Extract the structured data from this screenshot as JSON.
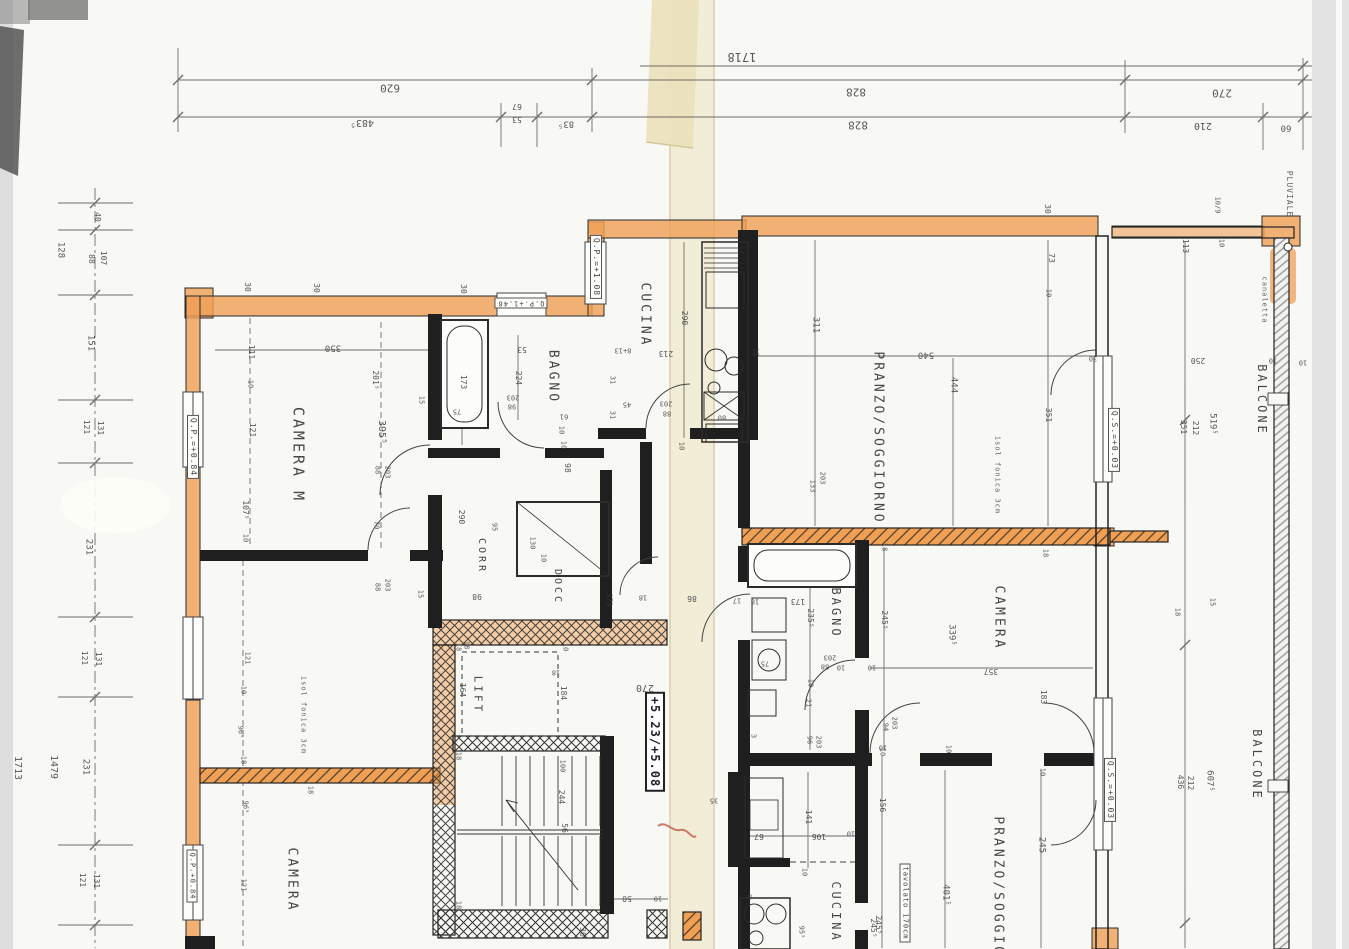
{
  "sheet": {
    "drawing_type": "scanned architectural floor plan, drawing rotated 180°",
    "overall_dimension": "1718",
    "rooms": [
      "CAMERA M",
      "CAMERA",
      "CAMERA",
      "BAGNO",
      "BAGNO",
      "CUCINA",
      "CUCINA",
      "CORR",
      "DOCC",
      "LIFT",
      "PRANZO/SOGGIORNO",
      "PRANZO/SOGGIORNO",
      "BALCONE",
      "BALCONE"
    ],
    "level_marks": [
      "Q.P.=+1.08",
      "Q.P.=+0.84",
      "Q.P.+1.48",
      "Q.S.=+0.03",
      "+5.23/+5.08"
    ],
    "notes": [
      "PLUVIALE",
      "canaletta",
      "isol fonica 3cm",
      "tavolato 170cm"
    ]
  },
  "colors": {
    "highlight_orange": "#efa058",
    "paper": "#f8f8f5",
    "fold_cream": "#f1ebd4",
    "line": "#222222",
    "scan_gray": "#dedede",
    "red_mark": "#b93a2e"
  },
  "annotations": [
    {
      "t": "1718",
      "x": 742,
      "y": 57,
      "r": 180,
      "s": 12
    },
    {
      "t": "620",
      "x": 390,
      "y": 88,
      "r": 180,
      "s": 11
    },
    {
      "t": "828",
      "x": 856,
      "y": 92,
      "r": 180,
      "s": 11
    },
    {
      "t": "483⁵",
      "x": 362,
      "y": 122,
      "r": 180,
      "s": 10
    },
    {
      "t": "67",
      "x": 517,
      "y": 106,
      "r": 180,
      "s": 8
    },
    {
      "t": "53",
      "x": 517,
      "y": 119,
      "r": 180,
      "s": 8
    },
    {
      "t": "83⁵",
      "x": 566,
      "y": 123,
      "r": 180,
      "s": 9
    },
    {
      "t": "828",
      "x": 858,
      "y": 125,
      "r": 180,
      "s": 11
    },
    {
      "t": "270",
      "x": 1222,
      "y": 93,
      "r": 180,
      "s": 11
    },
    {
      "t": "210",
      "x": 1203,
      "y": 125,
      "r": 180,
      "s": 10
    },
    {
      "t": "60",
      "x": 1286,
      "y": 127,
      "r": 180,
      "s": 9
    },
    {
      "t": "40",
      "x": 97,
      "y": 217,
      "s": 8
    },
    {
      "t": "128",
      "x": 60,
      "y": 250
    },
    {
      "t": "88",
      "x": 91,
      "y": 259,
      "s": 8
    },
    {
      "t": "107",
      "x": 103,
      "y": 258,
      "s": 8
    },
    {
      "t": "151",
      "x": 90,
      "y": 343
    },
    {
      "t": "121",
      "x": 86,
      "y": 427,
      "s": 8
    },
    {
      "t": "131",
      "x": 100,
      "y": 428,
      "s": 8
    },
    {
      "t": "231",
      "x": 88,
      "y": 547
    },
    {
      "t": "121",
      "x": 84,
      "y": 658,
      "s": 8
    },
    {
      "t": "131",
      "x": 98,
      "y": 659,
      "s": 8
    },
    {
      "t": "231",
      "x": 85,
      "y": 767
    },
    {
      "t": "1713",
      "x": 17,
      "y": 768,
      "s": 10
    },
    {
      "t": "1479",
      "x": 53,
      "y": 767,
      "s": 10
    },
    {
      "t": "121",
      "x": 82,
      "y": 880,
      "s": 8
    },
    {
      "t": "131",
      "x": 96,
      "y": 881,
      "s": 8
    },
    {
      "t": "30",
      "x": 247,
      "y": 287,
      "s": 8
    },
    {
      "t": "30",
      "x": 316,
      "y": 288,
      "s": 8
    },
    {
      "t": "111",
      "x": 251,
      "y": 352,
      "s": 8
    },
    {
      "t": "350",
      "x": 333,
      "y": 347,
      "r": 180,
      "s": 9
    },
    {
      "t": "10",
      "x": 250,
      "y": 384,
      "s": 7
    },
    {
      "t": "121",
      "x": 252,
      "y": 430,
      "s": 8
    },
    {
      "t": "395⁵",
      "x": 381,
      "y": 432,
      "s": 10
    },
    {
      "t": "CAMERA M",
      "x": 298,
      "y": 455,
      "s": 15,
      "k": "room"
    },
    {
      "t": "Q.P.=+0.84",
      "x": 193,
      "y": 447,
      "s": 8,
      "k": "level"
    },
    {
      "t": "201⁵",
      "x": 375,
      "y": 380,
      "s": 8
    },
    {
      "t": "15",
      "x": 421,
      "y": 400,
      "s": 7
    },
    {
      "t": "88",
      "x": 377,
      "y": 470,
      "s": 7
    },
    {
      "t": "203",
      "x": 387,
      "y": 472,
      "s": 7
    },
    {
      "t": "107⁵",
      "x": 245,
      "y": 510,
      "s": 8
    },
    {
      "t": "10",
      "x": 245,
      "y": 538,
      "s": 7
    },
    {
      "t": "70",
      "x": 376,
      "y": 525,
      "s": 7
    },
    {
      "t": "30",
      "x": 463,
      "y": 289,
      "s": 8
    },
    {
      "t": "Q.P.+1.48",
      "x": 521,
      "y": 303,
      "r": 180,
      "s": 7,
      "k": "level"
    },
    {
      "t": "173",
      "x": 463,
      "y": 382,
      "s": 8
    },
    {
      "t": "75",
      "x": 457,
      "y": 411,
      "r": 180,
      "s": 7
    },
    {
      "t": "53",
      "x": 522,
      "y": 349,
      "r": 180,
      "s": 8
    },
    {
      "t": "224",
      "x": 518,
      "y": 378,
      "s": 8
    },
    {
      "t": "BAGNO",
      "x": 553,
      "y": 377,
      "s": 13,
      "k": "room"
    },
    {
      "t": "203",
      "x": 513,
      "y": 397,
      "r": 180,
      "s": 7
    },
    {
      "t": "98",
      "x": 512,
      "y": 406,
      "r": 180,
      "s": 7
    },
    {
      "t": "61",
      "x": 564,
      "y": 416,
      "r": 180,
      "s": 7
    },
    {
      "t": "10",
      "x": 561,
      "y": 430,
      "s": 7
    },
    {
      "t": "10",
      "x": 563,
      "y": 445,
      "s": 7
    },
    {
      "t": "98",
      "x": 567,
      "y": 468,
      "s": 8
    },
    {
      "t": "8+13",
      "x": 623,
      "y": 350,
      "r": 180,
      "s": 7
    },
    {
      "t": "31",
      "x": 612,
      "y": 380,
      "s": 7
    },
    {
      "t": "45",
      "x": 627,
      "y": 404,
      "r": 180,
      "s": 7
    },
    {
      "t": "31",
      "x": 612,
      "y": 415,
      "s": 7
    },
    {
      "t": "Q.P.=+1.08",
      "x": 596,
      "y": 267,
      "s": 8,
      "k": "level"
    },
    {
      "t": "CUCINA",
      "x": 645,
      "y": 315,
      "s": 13,
      "k": "room"
    },
    {
      "t": "290",
      "x": 684,
      "y": 318,
      "s": 8
    },
    {
      "t": "213",
      "x": 666,
      "y": 353,
      "r": 180,
      "s": 8
    },
    {
      "t": "15",
      "x": 755,
      "y": 352,
      "s": 7
    },
    {
      "t": "311",
      "x": 815,
      "y": 325,
      "s": 9
    },
    {
      "t": "203",
      "x": 666,
      "y": 403,
      "r": 180,
      "s": 7
    },
    {
      "t": "88",
      "x": 667,
      "y": 413,
      "r": 180,
      "s": 7
    },
    {
      "t": "80",
      "x": 722,
      "y": 417,
      "r": 180,
      "s": 7
    },
    {
      "t": "10",
      "x": 681,
      "y": 446,
      "s": 7
    },
    {
      "t": "CORR",
      "x": 481,
      "y": 556,
      "s": 10,
      "k": "room"
    },
    {
      "t": "DOCC",
      "x": 557,
      "y": 587,
      "s": 10,
      "k": "room"
    },
    {
      "t": "290",
      "x": 461,
      "y": 517,
      "s": 8
    },
    {
      "t": "95",
      "x": 494,
      "y": 527,
      "s": 7
    },
    {
      "t": "130",
      "x": 532,
      "y": 543,
      "s": 7
    },
    {
      "t": "10",
      "x": 543,
      "y": 558,
      "s": 7
    },
    {
      "t": "98",
      "x": 477,
      "y": 596,
      "r": 180,
      "s": 8
    },
    {
      "t": "18",
      "x": 466,
      "y": 645,
      "s": 7
    },
    {
      "t": "86",
      "x": 692,
      "y": 598,
      "r": 180,
      "s": 8
    },
    {
      "t": "18",
      "x": 643,
      "y": 597,
      "r": 180,
      "s": 7
    },
    {
      "t": "17",
      "x": 737,
      "y": 600,
      "r": 180,
      "s": 7
    },
    {
      "t": "173",
      "x": 609,
      "y": 600,
      "s": 7
    },
    {
      "t": "LIFT",
      "x": 478,
      "y": 695,
      "s": 11,
      "k": "room"
    },
    {
      "t": "18",
      "x": 458,
      "y": 647,
      "s": 7
    },
    {
      "t": "164",
      "x": 462,
      "y": 690,
      "s": 8
    },
    {
      "t": "10",
      "x": 565,
      "y": 647,
      "s": 7
    },
    {
      "t": "18",
      "x": 556,
      "y": 672,
      "r": 180,
      "s": 7
    },
    {
      "t": "184",
      "x": 563,
      "y": 693,
      "s": 8
    },
    {
      "t": "270",
      "x": 645,
      "y": 687,
      "r": 180,
      "s": 10
    },
    {
      "t": "+5.23/+5.08",
      "x": 655,
      "y": 742,
      "s": 12,
      "k": "elev"
    },
    {
      "t": "18",
      "x": 458,
      "y": 756,
      "s": 7
    },
    {
      "t": "100",
      "x": 562,
      "y": 766,
      "s": 7
    },
    {
      "t": "244",
      "x": 561,
      "y": 797,
      "s": 8
    },
    {
      "t": "56",
      "x": 564,
      "y": 828,
      "s": 8
    },
    {
      "t": "18",
      "x": 458,
      "y": 905,
      "s": 7
    },
    {
      "t": "50",
      "x": 627,
      "y": 898,
      "r": 180,
      "s": 8
    },
    {
      "t": "10",
      "x": 658,
      "y": 898,
      "r": 180,
      "s": 7
    },
    {
      "t": "30",
      "x": 582,
      "y": 932,
      "s": 8
    },
    {
      "t": "3",
      "x": 753,
      "y": 736,
      "s": 7
    },
    {
      "t": "30",
      "x": 1047,
      "y": 209,
      "s": 8
    },
    {
      "t": "PRANZO/SOGGIORNO",
      "x": 878,
      "y": 438,
      "s": 13,
      "k": "room"
    },
    {
      "t": "540",
      "x": 926,
      "y": 354,
      "r": 180,
      "s": 9
    },
    {
      "t": "444",
      "x": 953,
      "y": 385,
      "s": 9
    },
    {
      "t": "133",
      "x": 812,
      "y": 486,
      "s": 7
    },
    {
      "t": "203",
      "x": 822,
      "y": 478,
      "s": 7
    },
    {
      "t": "isol fonica 3cm",
      "x": 997,
      "y": 475,
      "s": 7,
      "k": "note"
    },
    {
      "t": "isol fonica 3cm",
      "x": 303,
      "y": 715,
      "s": 7,
      "k": "note"
    },
    {
      "t": "73",
      "x": 1051,
      "y": 258,
      "s": 8
    },
    {
      "t": "10",
      "x": 1048,
      "y": 293,
      "s": 7
    },
    {
      "t": "351",
      "x": 1048,
      "y": 415,
      "s": 8
    },
    {
      "t": "Q.S.=+0.03",
      "x": 1114,
      "y": 440,
      "s": 8,
      "k": "level"
    },
    {
      "t": "30",
      "x": 1093,
      "y": 358,
      "r": 180,
      "s": 7
    },
    {
      "t": "113",
      "x": 1185,
      "y": 246,
      "s": 8
    },
    {
      "t": "10/9",
      "x": 1217,
      "y": 205,
      "s": 7
    },
    {
      "t": "10",
      "x": 1221,
      "y": 243,
      "s": 7
    },
    {
      "t": "250",
      "x": 1198,
      "y": 360,
      "r": 180,
      "s": 8
    },
    {
      "t": "351",
      "x": 1183,
      "y": 427,
      "s": 8
    },
    {
      "t": "212",
      "x": 1195,
      "y": 428,
      "s": 8
    },
    {
      "t": "519⁵",
      "x": 1212,
      "y": 424,
      "s": 9
    },
    {
      "t": "BALCONE",
      "x": 1262,
      "y": 400,
      "s": 12,
      "k": "room"
    },
    {
      "t": "canaletta",
      "x": 1264,
      "y": 300,
      "s": 7,
      "k": "note"
    },
    {
      "t": "PLUVIALE",
      "x": 1289,
      "y": 194,
      "s": 8,
      "k": "note"
    },
    {
      "t": "10",
      "x": 1273,
      "y": 360,
      "r": 180,
      "s": 7
    },
    {
      "t": "10",
      "x": 1303,
      "y": 362,
      "r": 180,
      "s": 7
    },
    {
      "t": "18",
      "x": 755,
      "y": 601,
      "r": 180,
      "s": 7
    },
    {
      "t": "173",
      "x": 798,
      "y": 601,
      "r": 180,
      "s": 8
    },
    {
      "t": "235⁵",
      "x": 810,
      "y": 618,
      "s": 8
    },
    {
      "t": "BAGNO",
      "x": 836,
      "y": 613,
      "s": 12,
      "k": "room"
    },
    {
      "t": "245⁵",
      "x": 884,
      "y": 620,
      "s": 8
    },
    {
      "t": "18",
      "x": 884,
      "y": 547,
      "s": 7
    },
    {
      "t": "18",
      "x": 1045,
      "y": 553,
      "s": 7
    },
    {
      "t": "CAMERA",
      "x": 999,
      "y": 618,
      "s": 13,
      "k": "room"
    },
    {
      "t": "339⁵",
      "x": 951,
      "y": 635,
      "s": 9
    },
    {
      "t": "357",
      "x": 991,
      "y": 671,
      "r": 180,
      "s": 8
    },
    {
      "t": "75",
      "x": 765,
      "y": 663,
      "r": 180,
      "s": 7
    },
    {
      "t": "203",
      "x": 830,
      "y": 657,
      "r": 180,
      "s": 7
    },
    {
      "t": "88",
      "x": 825,
      "y": 666,
      "r": 180,
      "s": 7
    },
    {
      "t": "10",
      "x": 841,
      "y": 667,
      "r": 180,
      "s": 7
    },
    {
      "t": "10",
      "x": 872,
      "y": 667,
      "r": 180,
      "s": 7
    },
    {
      "t": "10",
      "x": 810,
      "y": 683,
      "s": 7
    },
    {
      "t": "21",
      "x": 808,
      "y": 703,
      "s": 7
    },
    {
      "t": "96",
      "x": 809,
      "y": 740,
      "s": 7
    },
    {
      "t": "203",
      "x": 818,
      "y": 742,
      "s": 7
    },
    {
      "t": "94",
      "x": 885,
      "y": 727,
      "s": 7
    },
    {
      "t": "203",
      "x": 894,
      "y": 723,
      "s": 7
    },
    {
      "t": "10",
      "x": 882,
      "y": 752,
      "s": 7
    },
    {
      "t": "183",
      "x": 1043,
      "y": 697,
      "s": 8
    },
    {
      "t": "10",
      "x": 948,
      "y": 749,
      "s": 7
    },
    {
      "t": "10",
      "x": 1042,
      "y": 772,
      "s": 7
    },
    {
      "t": "10",
      "x": 883,
      "y": 747,
      "r": 180,
      "s": 7
    },
    {
      "t": "156",
      "x": 882,
      "y": 805,
      "s": 8
    },
    {
      "t": "245",
      "x": 1041,
      "y": 845,
      "s": 9
    },
    {
      "t": "PRANZO/SOGGIORNO",
      "x": 998,
      "y": 903,
      "s": 13,
      "k": "room"
    },
    {
      "t": "401⁵",
      "x": 945,
      "y": 895,
      "s": 9
    },
    {
      "t": "245⁵",
      "x": 878,
      "y": 925,
      "s": 8
    },
    {
      "t": "tavolato 170cm",
      "x": 905,
      "y": 903,
      "s": 7,
      "k": "notebox"
    },
    {
      "t": "Q.S.=+0.03",
      "x": 1110,
      "y": 790,
      "s": 8,
      "k": "level"
    },
    {
      "t": "436",
      "x": 1180,
      "y": 782,
      "s": 8
    },
    {
      "t": "212",
      "x": 1190,
      "y": 783,
      "s": 8
    },
    {
      "t": "607⁵",
      "x": 1209,
      "y": 781,
      "s": 9
    },
    {
      "t": "BALCONE",
      "x": 1257,
      "y": 765,
      "s": 12,
      "k": "room"
    },
    {
      "t": "18",
      "x": 1177,
      "y": 612,
      "s": 7
    },
    {
      "t": "15",
      "x": 1212,
      "y": 602,
      "s": 7
    },
    {
      "t": "35",
      "x": 714,
      "y": 800,
      "r": 180,
      "s": 7
    },
    {
      "t": "67",
      "x": 759,
      "y": 836,
      "r": 180,
      "s": 8
    },
    {
      "t": "141",
      "x": 808,
      "y": 817,
      "s": 8
    },
    {
      "t": "106",
      "x": 819,
      "y": 836,
      "r": 180,
      "s": 8
    },
    {
      "t": "10",
      "x": 851,
      "y": 833,
      "r": 180,
      "s": 7
    },
    {
      "t": "10",
      "x": 804,
      "y": 872,
      "s": 7
    },
    {
      "t": "8",
      "x": 750,
      "y": 896,
      "r": 180,
      "s": 7
    },
    {
      "t": "CUCINA",
      "x": 836,
      "y": 912,
      "s": 12,
      "k": "room"
    },
    {
      "t": "245⁵",
      "x": 873,
      "y": 928,
      "s": 8
    },
    {
      "t": "95⁵",
      "x": 801,
      "y": 932,
      "s": 7
    },
    {
      "t": "CAMERA",
      "x": 292,
      "y": 880,
      "s": 13,
      "k": "room"
    },
    {
      "t": "121",
      "x": 243,
      "y": 885,
      "s": 7
    },
    {
      "t": "96⁵",
      "x": 245,
      "y": 807,
      "s": 7
    },
    {
      "t": "96⁵",
      "x": 240,
      "y": 732,
      "s": 7
    },
    {
      "t": "18",
      "x": 243,
      "y": 760,
      "s": 7
    },
    {
      "t": "18",
      "x": 310,
      "y": 790,
      "s": 7
    },
    {
      "t": "10",
      "x": 243,
      "y": 690,
      "s": 7
    },
    {
      "t": "121",
      "x": 247,
      "y": 658,
      "s": 7
    },
    {
      "t": "Q.P.+0.84",
      "x": 192,
      "y": 876,
      "s": 7,
      "k": "level"
    },
    {
      "t": "88",
      "x": 377,
      "y": 587,
      "s": 7
    },
    {
      "t": "203",
      "x": 387,
      "y": 585,
      "s": 7
    },
    {
      "t": "15",
      "x": 420,
      "y": 594,
      "s": 7
    }
  ]
}
